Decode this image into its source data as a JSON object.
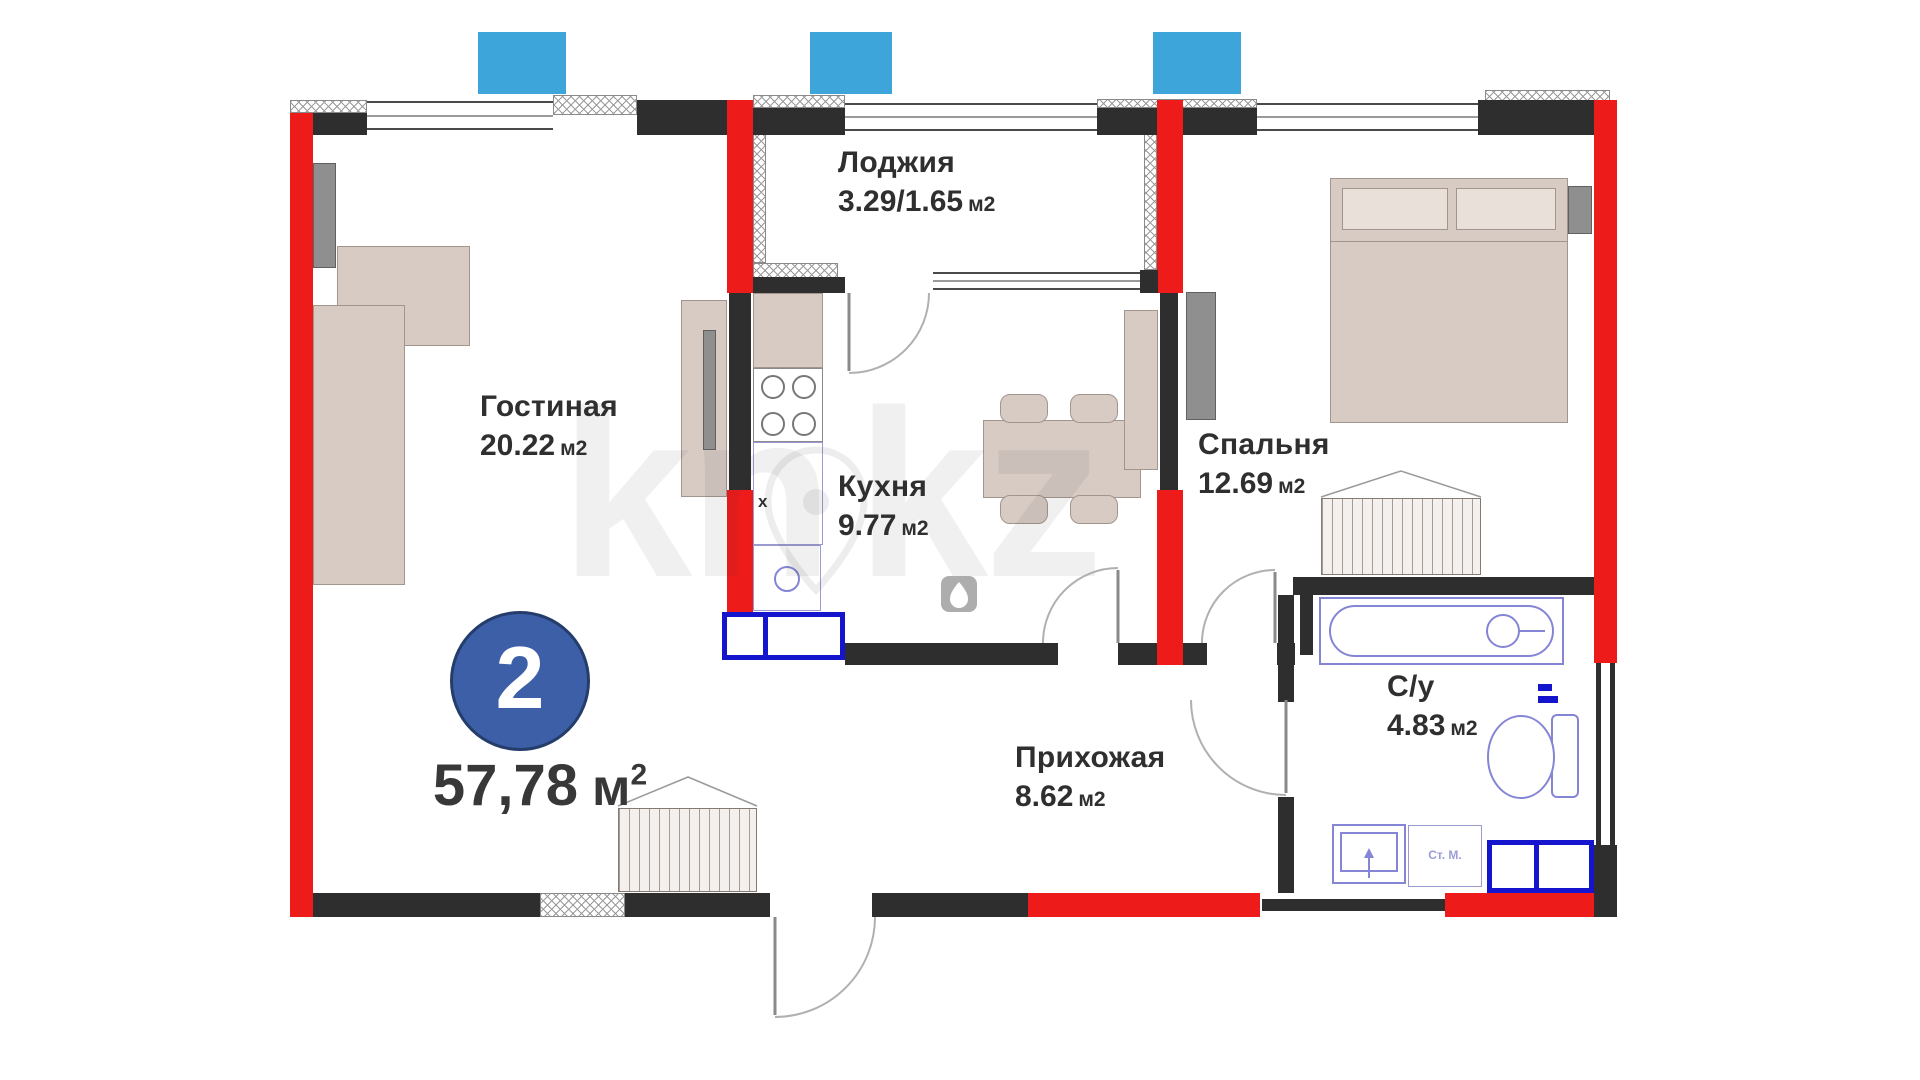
{
  "plan": {
    "badge": {
      "number": "2"
    },
    "total_area": {
      "value": "57,78",
      "unit": "м",
      "sup": "2"
    },
    "rooms": [
      {
        "name": "Лоджия",
        "area": "3.29/1.65",
        "unit": "м2"
      },
      {
        "name": "Гостиная",
        "area": "20.22",
        "unit": "м2"
      },
      {
        "name": "Кухня",
        "area": "9.77",
        "unit": "м2"
      },
      {
        "name": "Спальня",
        "area": "12.69",
        "unit": "м2"
      },
      {
        "name": "Прихожая",
        "area": "8.62",
        "unit": "м2"
      },
      {
        "name": "С/у",
        "area": "4.83",
        "unit": "м2"
      }
    ],
    "annotations": {
      "washing_machine": "Ст. М.",
      "vent_marker": "x"
    },
    "watermark": {
      "left": "kn",
      "right": "kz"
    },
    "colors": {
      "exterior_wall": "#ee1b1b",
      "interior_wall": "#2e2e2e",
      "window_marker_blue": "#3da5d9",
      "plumbing_blue": "#1515cd",
      "sanitary_outline": "#8585d6",
      "furniture_fill": "#d7cbc4",
      "badge_blue": "#3d5fa8",
      "text": "#2f2f2f"
    }
  }
}
